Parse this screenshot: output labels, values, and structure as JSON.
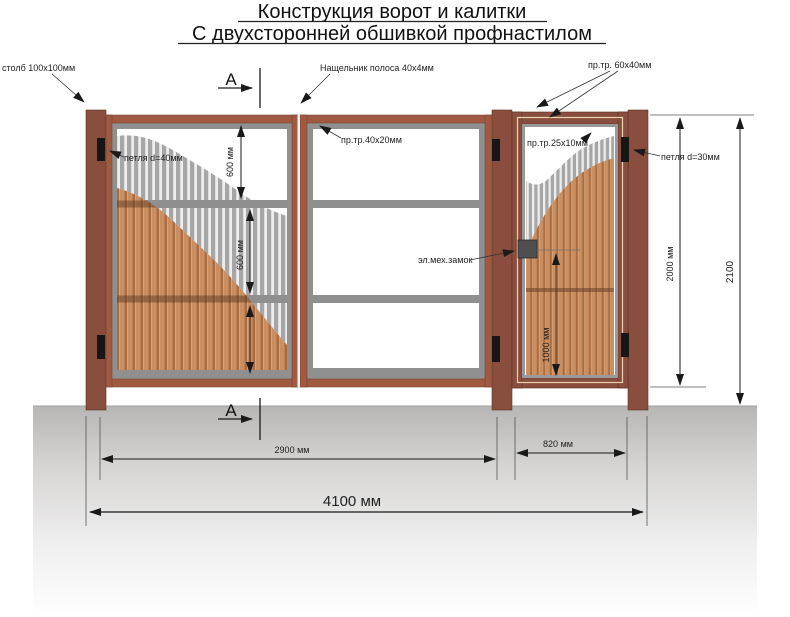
{
  "title": {
    "line1": "Конструкция ворот и калитки",
    "line2": "С двухсторонней  обшивкой профнастилом"
  },
  "callouts": {
    "post": "столб 100x100мм",
    "cover_strip": "Нащельник полоса 40x4мм",
    "tube_60x40": "пр.тр. 60x40мм",
    "hinge_40": "петля d=40мм",
    "tube_40x20": "пр.тр.40x20мм",
    "tube_25x10": "пр.тр.25x10мм",
    "lock": "эл.мех.замок",
    "hinge_30": "петля d=30мм"
  },
  "dimensions": {
    "panel_600_top": "600 мм",
    "panel_600_mid": "600 мм",
    "gate_height": "2000 мм",
    "total_height": "2100",
    "lock_height": "1000 мм",
    "gates_width": "2900 мм",
    "wicket_width": "820 мм",
    "total_width": "4100 мм"
  },
  "section_marker": "А",
  "colors": {
    "post": "#8a4e3e",
    "leaf_frame": "#a05a42",
    "steel_gray": "#8f8f8f",
    "sheet_tan": "#c98f61",
    "sheet_tan_dark": "#aa6b40",
    "ground_top": "#b8b8b8",
    "line": "#1a1a1a"
  }
}
